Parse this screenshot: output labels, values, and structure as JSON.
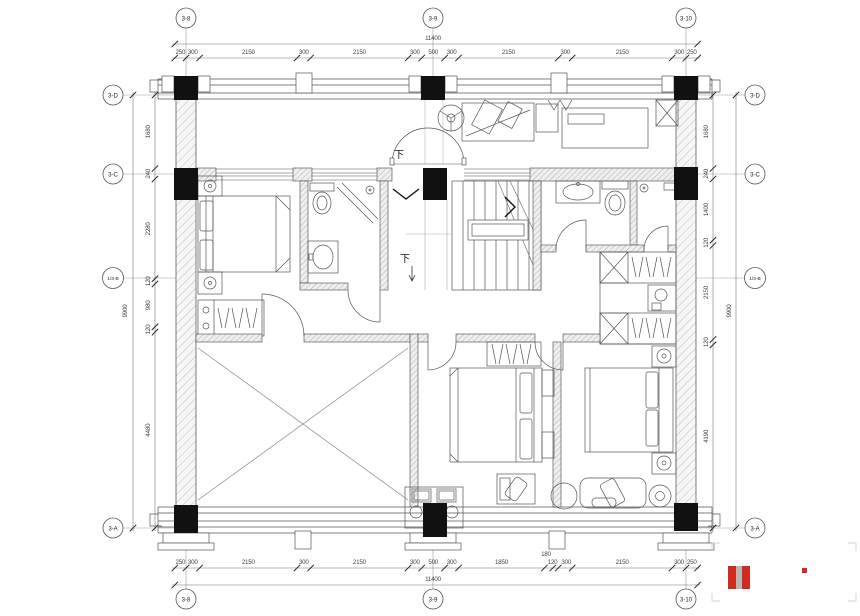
{
  "meta": {
    "type": "architectural-floor-plan",
    "down_label": "下"
  },
  "grid": {
    "top": [
      "3-8",
      "3-9",
      "3-10"
    ],
    "bottom": [
      "3-8",
      "3-9",
      "3-10"
    ],
    "left": [
      "3-D",
      "3-C",
      "1/3-B",
      "3-A"
    ],
    "right": [
      "3-D",
      "3-C",
      "1/3-B",
      "3-A"
    ]
  },
  "dims": {
    "overall_w": "11400",
    "overall_h": "9900",
    "top": [
      "250",
      "300",
      "2150",
      "300",
      "2150",
      "300",
      "500",
      "300",
      "2150",
      "300",
      "2150",
      "300",
      "250"
    ],
    "bottom": [
      "250",
      "300",
      "2150",
      "300",
      "2150",
      "300",
      "500",
      "300",
      "1850",
      "180",
      "120",
      "300",
      "2150",
      "300",
      "250"
    ],
    "left": [
      "1680",
      "240",
      "2280",
      "120",
      "980",
      "120",
      "4480"
    ],
    "right": [
      "1680",
      "240",
      "1400",
      "120",
      "2150",
      "120",
      "4190"
    ]
  },
  "colors": {
    "logo_red": "#cf2b20",
    "logo_gray": "#b7b7b7"
  }
}
